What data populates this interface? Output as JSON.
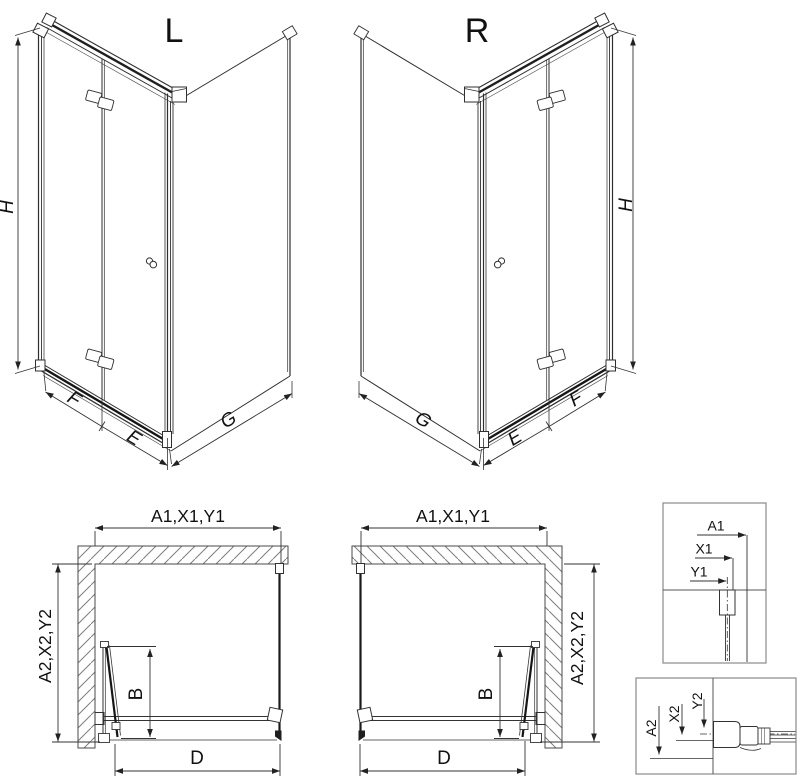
{
  "diagram": {
    "type": "shower-enclosure-technical-drawing",
    "variant_left": {
      "label": "L",
      "height_dim": "H",
      "front_hinge_dim": "F",
      "front_door_dim": "E",
      "side_dim": "G"
    },
    "variant_right": {
      "label": "R",
      "height_dim": "H",
      "front_hinge_dim": "F",
      "front_door_dim": "E",
      "side_dim": "G"
    },
    "plan_left": {
      "width_dim": "A1,X1,Y1",
      "depth_dim": "A2,X2,Y2",
      "door_fold_dim": "B",
      "entry_dim": "D"
    },
    "plan_right": {
      "width_dim": "A1,X1,Y1",
      "depth_dim": "A2,X2,Y2",
      "door_fold_dim": "B",
      "entry_dim": "D"
    },
    "detail_top": {
      "labels": [
        "A1",
        "X1",
        "Y1"
      ]
    },
    "detail_bottom": {
      "labels": [
        "A2",
        "X2",
        "Y2"
      ]
    },
    "colors": {
      "line": "#2f2f2f",
      "dim_line": "#333333",
      "hatch": "#7d7d7d",
      "detail_border": "#8a8a8a",
      "dark_profile": "#161616",
      "background": "#ffffff",
      "text": "#111111"
    }
  }
}
